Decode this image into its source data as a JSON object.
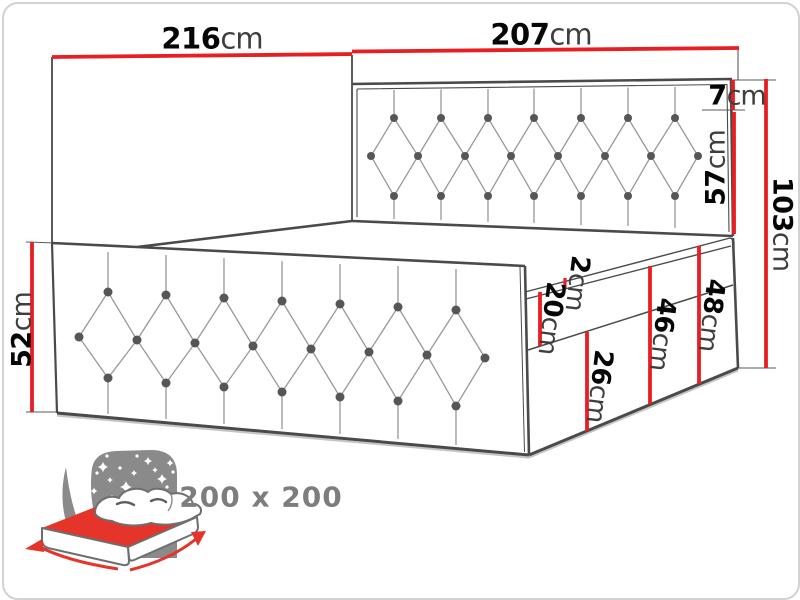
{
  "title": "Bed dimension diagram",
  "dimensions": {
    "side_length": {
      "value": "216",
      "unit": "cm"
    },
    "headboard_width": {
      "value": "207",
      "unit": "cm"
    },
    "headboard_top_frame": {
      "value": "7",
      "unit": "cm"
    },
    "headboard_panel": {
      "value": "57",
      "unit": "cm"
    },
    "total_height": {
      "value": "103",
      "unit": "cm"
    },
    "side_panel_height": {
      "value": "52",
      "unit": "cm"
    },
    "topper_height": {
      "value": "2",
      "unit": "cm"
    },
    "mattress_height": {
      "value": "20",
      "unit": "cm"
    },
    "base_lower_height": {
      "value": "26",
      "unit": "cm"
    },
    "base_upper_height": {
      "value": "46",
      "unit": "cm"
    },
    "base_total_height": {
      "value": "48",
      "unit": "cm"
    }
  },
  "logo": {
    "size_label": "200 x 200"
  },
  "colors": {
    "dimension_red": "#e81e23",
    "outline_gray": "#4a4a4a",
    "crease_gray": "#9a9a9a",
    "button_gray": "#565656",
    "unit_text_gray": "#3e3e3e",
    "logo_panel_gray": "#8a8a8a",
    "logo_red": "#e5352b",
    "logo_text_gray": "#7d7d7d"
  }
}
